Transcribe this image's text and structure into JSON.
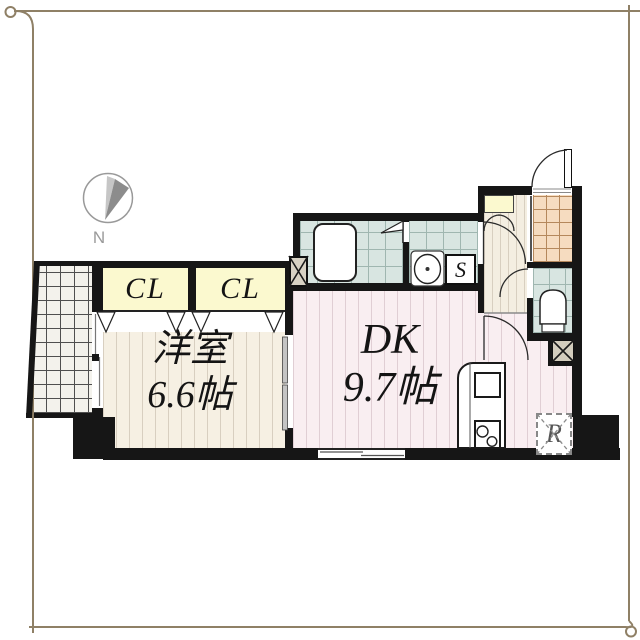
{
  "plan": {
    "compass_label": "N",
    "western_room": {
      "name": "洋室",
      "size": "6.6帖"
    },
    "dining_kitchen": {
      "name": "DK",
      "size": "9.7帖"
    },
    "closet_left": "CL",
    "closet_right": "CL",
    "laundry_label": "S",
    "refrigerator_label": "R"
  },
  "colors": {
    "wall": "#161616",
    "closet_fill": "#fbf9cf",
    "western_floor": "#f6f0e3",
    "dk_floor": "#f9eef1",
    "wet_floor": "#d8e5e1",
    "genkan_floor": "#f6dcc0",
    "frame": "#8f8066"
  }
}
